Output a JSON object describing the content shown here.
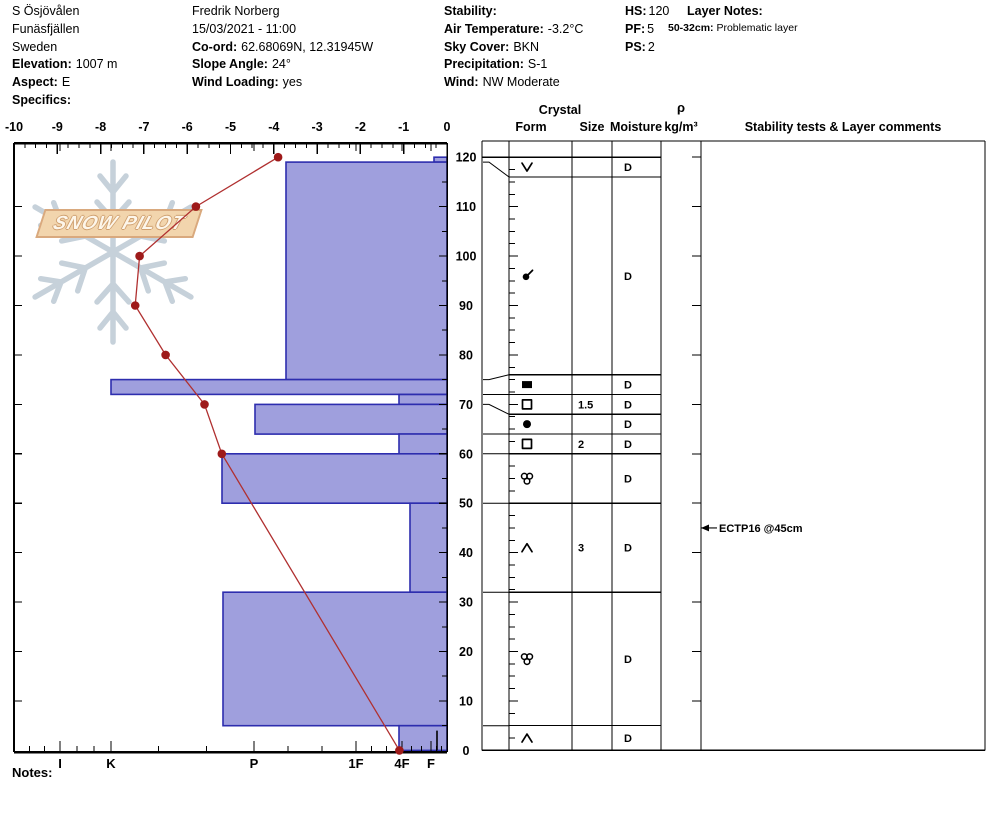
{
  "header": {
    "location": {
      "line1": "S Ösjövålen",
      "line2": "Funäsfjällen",
      "line3": "Sweden",
      "elevation_label": "Elevation:",
      "elevation": "1007 m",
      "aspect_label": "Aspect:",
      "aspect": "E",
      "specifics_label": "Specifics:",
      "specifics": ""
    },
    "observer": {
      "name": "Fredrik Norberg",
      "datetime": "15/03/2021 - 11:00",
      "coord_label": "Co-ord:",
      "coord": "62.68069N, 12.31945W",
      "slope_label": "Slope Angle:",
      "slope": "24°",
      "wind_loading_label": "Wind Loading:",
      "wind_loading": "yes"
    },
    "conditions": {
      "stability_label": "Stability:",
      "stability": "",
      "air_temp_label": "Air Temperature:",
      "air_temp": "-3.2°C",
      "sky_label": "Sky Cover:",
      "sky": "BKN",
      "precip_label": "Precipitation:",
      "precip": "S-1",
      "wind_label": "Wind:",
      "wind": "NW Moderate"
    },
    "scores": {
      "hs_label": "HS:",
      "hs": "120",
      "pf_label": "PF:",
      "pf": "5",
      "ps_label": "PS:",
      "ps": "2"
    },
    "layer_notes": {
      "label": "Layer Notes:",
      "entry_label": "50-32cm:",
      "entry_text": "Problematic layer"
    }
  },
  "logo": {
    "text": "SNOW PILOT"
  },
  "notes_label": "Notes:",
  "table": {
    "crystal_label": "Crystal",
    "form_label": "Form",
    "size_label": "Size",
    "moisture_label": "Moisture",
    "rho_label": "ρ",
    "rho_units": "kg/m³",
    "comments_label": "Stability tests & Layer comments"
  },
  "chart_data": {
    "type": "snow-profile",
    "temp_axis": {
      "unit": "°C",
      "min": -10,
      "max": 0,
      "tick_step": 1,
      "minor_step": 0.25
    },
    "height_axis": {
      "unit": "cm",
      "min": 0,
      "max": 120,
      "label_step": 10
    },
    "hardness_axis": {
      "categories": [
        "I",
        "K",
        "P",
        "1F",
        "4F",
        "F"
      ],
      "x_px": {
        "I": 60,
        "K": 111,
        "P": 254,
        "1F": 356,
        "4F": 402,
        "F": 431
      }
    },
    "temperature_profile": [
      {
        "height_cm": 120,
        "temp_c": -3.9
      },
      {
        "height_cm": 110,
        "temp_c": -5.8
      },
      {
        "height_cm": 100,
        "temp_c": -7.1
      },
      {
        "height_cm": 90,
        "temp_c": -7.2
      },
      {
        "height_cm": 80,
        "temp_c": -6.5
      },
      {
        "height_cm": 70,
        "temp_c": -5.6
      },
      {
        "height_cm": 60,
        "temp_c": -5.2
      },
      {
        "height_cm": 0,
        "temp_c": -1.1
      }
    ],
    "layers": [
      {
        "top_cm": 120,
        "bottom_cm": 119,
        "row_top_cm": 120,
        "row_bottom_cm": 116,
        "hardness": "F",
        "bar_left_x": 434,
        "form": "SH",
        "form_name": "surface hoar",
        "size_mm": "",
        "moisture": "D"
      },
      {
        "top_cm": 119,
        "bottom_cm": 75,
        "row_top_cm": 116,
        "row_bottom_cm": 76,
        "hardness": "P-",
        "bar_left_x": 286,
        "form": "DF",
        "form_name": "decomposing fragments",
        "size_mm": "",
        "moisture": "D"
      },
      {
        "top_cm": 75,
        "bottom_cm": 72,
        "row_top_cm": 76,
        "row_bottom_cm": 72,
        "hardness": "K",
        "bar_left_x": 111,
        "form": "IF",
        "form_name": "ice formation",
        "size_mm": "",
        "moisture": "D"
      },
      {
        "top_cm": 72,
        "bottom_cm": 70,
        "row_top_cm": 72,
        "row_bottom_cm": 68,
        "hardness": "4F",
        "bar_left_x": 399,
        "form": "FC",
        "form_name": "faceted crystals",
        "size_mm": "1.5",
        "moisture": "D"
      },
      {
        "top_cm": 70,
        "bottom_cm": 64,
        "row_top_cm": 68,
        "row_bottom_cm": 64,
        "hardness": "P",
        "bar_left_x": 255,
        "form": "RG",
        "form_name": "rounded grains",
        "size_mm": "",
        "moisture": "D"
      },
      {
        "top_cm": 64,
        "bottom_cm": 60,
        "row_top_cm": 64,
        "row_bottom_cm": 60,
        "hardness": "4F",
        "bar_left_x": 399,
        "form": "FC",
        "form_name": "faceted crystals",
        "size_mm": "2",
        "moisture": "D"
      },
      {
        "top_cm": 60,
        "bottom_cm": 50,
        "row_top_cm": 60,
        "row_bottom_cm": 50,
        "hardness": "P+",
        "bar_left_x": 222,
        "form": "MF",
        "form_name": "melt forms",
        "size_mm": "",
        "moisture": "D"
      },
      {
        "top_cm": 50,
        "bottom_cm": 32,
        "row_top_cm": 50,
        "row_bottom_cm": 32,
        "hardness": "4F-",
        "bar_left_x": 410,
        "form": "DH",
        "form_name": "depth hoar",
        "size_mm": "3",
        "moisture": "D"
      },
      {
        "top_cm": 32,
        "bottom_cm": 5,
        "row_top_cm": 32,
        "row_bottom_cm": 5,
        "hardness": "P+",
        "bar_left_x": 223,
        "form": "MF",
        "form_name": "melt forms",
        "size_mm": "",
        "moisture": "D"
      },
      {
        "top_cm": 5,
        "bottom_cm": 0,
        "row_top_cm": 5,
        "row_bottom_cm": 0,
        "hardness": "4F",
        "bar_left_x": 399,
        "form": "DH",
        "form_name": "depth hoar",
        "size_mm": "",
        "moisture": "D"
      }
    ],
    "basal_divider": {
      "x": 437,
      "top_cm": 4,
      "bottom_cm": 0
    },
    "annotation": {
      "text": "ECTP16 @45cm",
      "height_cm": 45
    }
  },
  "colors": {
    "bar_fill": "#9f9fdd",
    "bar_border": "#2d2dae",
    "temp_line": "#b03030",
    "temp_dot": "#9e1a1a",
    "logo_flake": "#c6d1da",
    "logo_band_fill": "#f2d5ad",
    "logo_band_border": "#d9a97e",
    "logo_text": "#fdf6ea",
    "logo_text_outline": "#cfa070"
  }
}
